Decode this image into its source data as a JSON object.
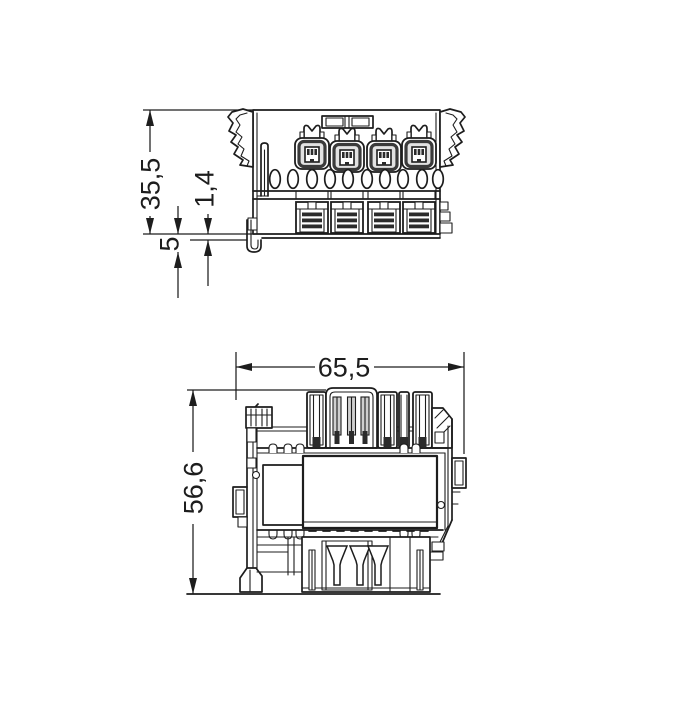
{
  "page": {
    "background": "#ffffff",
    "line_color": "#1d1d1d"
  },
  "drawing": {
    "type": "technical-dimension-drawing",
    "views": {
      "side_view": {
        "name": "side view",
        "dims": {
          "total_height": "35,5",
          "rail_lip": "1,4",
          "foot_height": "5"
        }
      },
      "top_view": {
        "name": "top view",
        "dims": {
          "total_width": "65,5",
          "total_depth": "56,6"
        }
      }
    }
  }
}
